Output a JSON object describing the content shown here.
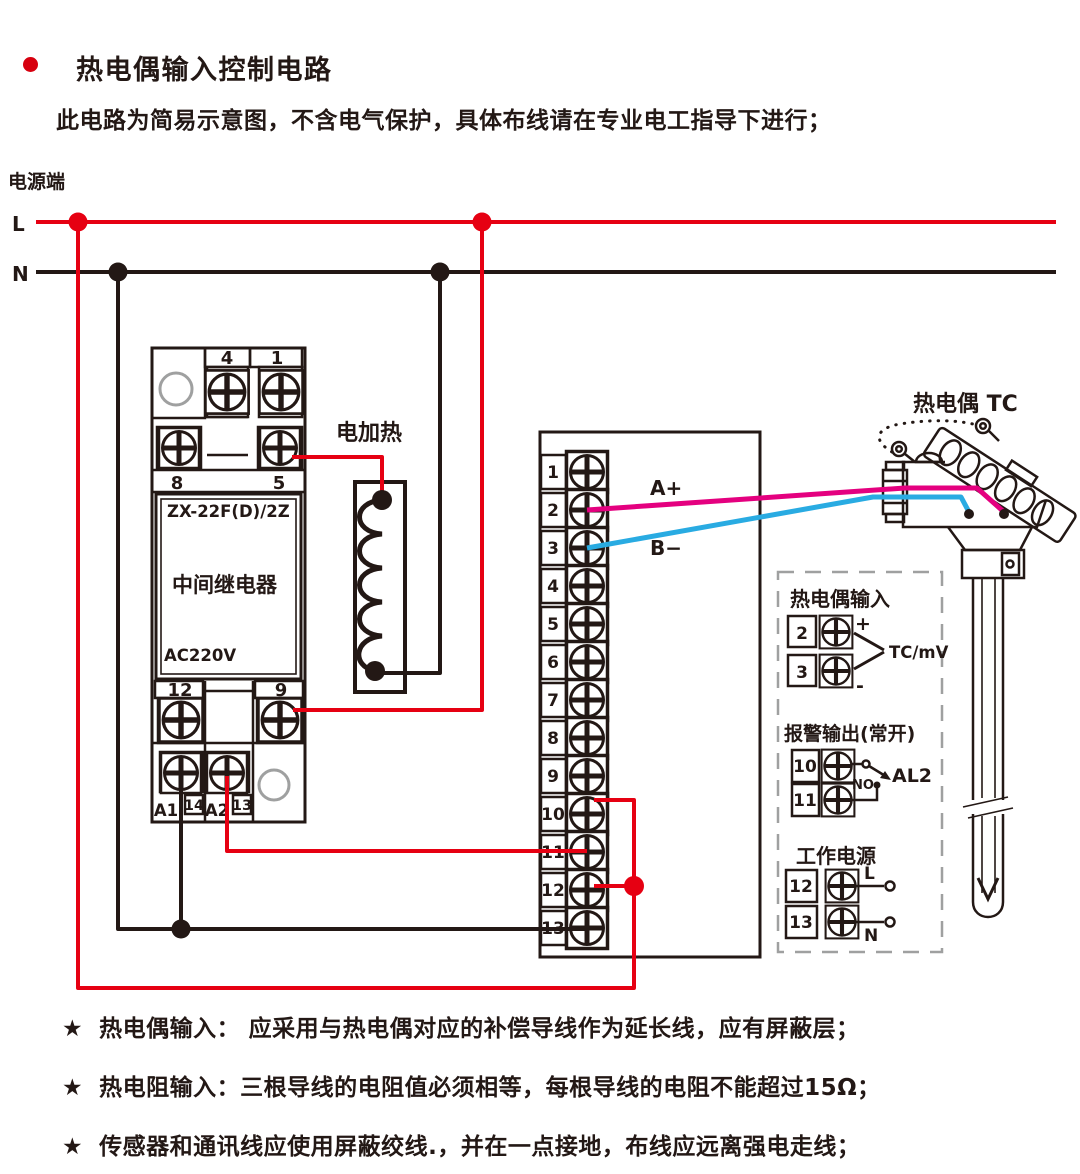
{
  "header": {
    "title": "热电偶输入控制电路",
    "subtitle": "此电路为简易示意图，不含电气保护，具体布线请在专业电工指导下进行；"
  },
  "power": {
    "label": "电源端",
    "l": "L",
    "n": "N"
  },
  "relay": {
    "model": "ZX-22F(D)/2Z",
    "name": "中间继电器",
    "voltage": "AC220V",
    "t4": "4",
    "t1": "1",
    "t8": "8",
    "t5": "5",
    "t12": "12",
    "t9": "9",
    "a1": "A1",
    "t14": "14",
    "a2": "A2",
    "t13": "13"
  },
  "heater": {
    "label": "电加热"
  },
  "terminal_block": {
    "terminals": [
      "1",
      "2",
      "3",
      "4",
      "5",
      "6",
      "7",
      "8",
      "9",
      "10",
      "11",
      "12",
      "13"
    ],
    "wire_a": "A+",
    "wire_b": "B−"
  },
  "thermocouple": {
    "label": "热电偶 TC"
  },
  "io_panel": {
    "tc_input": {
      "title": "热电偶输入",
      "t2": "2",
      "t3": "3",
      "plus": "+",
      "minus": "-",
      "signal": "TC/mV"
    },
    "alarm": {
      "title": "报警输出(常开)",
      "t10": "10",
      "t11": "11",
      "contact": "NO",
      "output": "AL2"
    },
    "supply": {
      "title": "工作电源",
      "t12": "12",
      "t13": "13",
      "l": "L",
      "n": "N"
    }
  },
  "notes": [
    {
      "star": "★",
      "text": "热电偶输入： 应采用与热电偶对应的补偿导线作为延长线，应有屏蔽层；"
    },
    {
      "star": "★",
      "text": "热电阻输入：三根导线的电阻值必须相等，每根导线的电阻不能超过15Ω；"
    },
    {
      "star": "★",
      "text": "传感器和通讯线应使用屏蔽绞线.，并在一点接地，布线应远离强电走线；"
    }
  ],
  "colors": {
    "red": "#e60012",
    "magenta": "#e4007f",
    "blue": "#29abe2",
    "line": "#231815",
    "gray": "#9fa0a0"
  }
}
